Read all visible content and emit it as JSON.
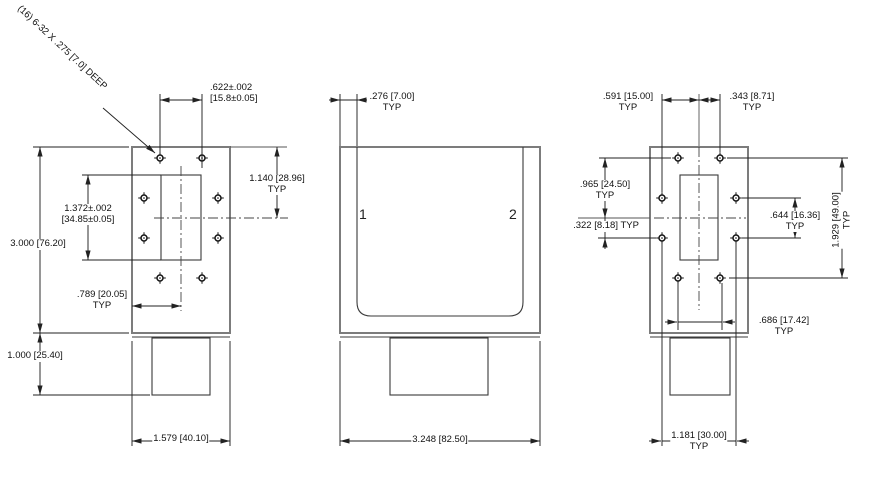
{
  "drawing": {
    "note": "(16) 6-32 X .275 [7.0] DEEP",
    "colors": {
      "outline": "#7c7c7c",
      "lines": "#222222",
      "background": "#ffffff"
    },
    "labels": {
      "d622": {
        "l1": ".622±.002",
        "l2": "[15.8±0.05]"
      },
      "d1140": {
        "l1": "1.140 [28.96]",
        "typ": "TYP"
      },
      "d1372": {
        "l1": "1.372±.002",
        "l2": "[34.85±0.05]"
      },
      "d3000": {
        "l1": "3.000 [76.20]"
      },
      "d789": {
        "l1": ".789 [20.05]",
        "typ": "TYP"
      },
      "d1000": {
        "l1": "1.000 [25.40]"
      },
      "d1579": {
        "l1": "1.579 [40.10]"
      },
      "d276": {
        "l1": ".276 [7.00]",
        "typ": "TYP"
      },
      "d3248": {
        "l1": "3.248 [82.50]"
      },
      "port1": "1",
      "port2": "2",
      "d591": {
        "l1": ".591 [15.00]",
        "typ": "TYP"
      },
      "d343": {
        "l1": ".343 [8.71]",
        "typ": "TYP"
      },
      "d965": {
        "l1": ".965 [24.50]",
        "typ": "TYP"
      },
      "d322": {
        "l1": ".322 [8.18] TYP"
      },
      "d644": {
        "l1": ".644 [16.36]",
        "typ": "TYP"
      },
      "d1929": {
        "l1": "1.929 [49.00]",
        "typ": "TYP"
      },
      "d686": {
        "l1": ".686 [17.42]",
        "typ": "TYP"
      },
      "d1181": {
        "l1": "1.181 [30.00]",
        "typ": "TYP"
      }
    }
  }
}
